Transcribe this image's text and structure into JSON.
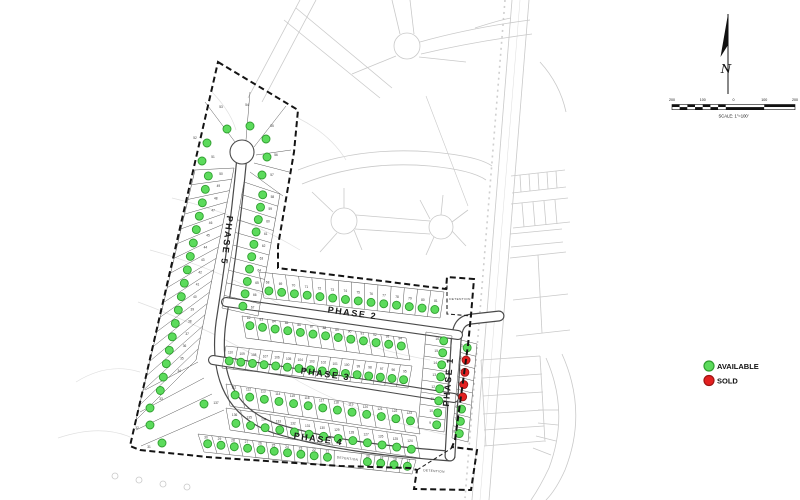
{
  "legend": {
    "available_label": "AVAILABLE",
    "sold_label": "SOLD",
    "available_color": "#5cdb5c",
    "available_stroke": "#2f9e2f",
    "sold_color": "#e32020",
    "sold_stroke": "#9e1414"
  },
  "compass": {
    "label": "N"
  },
  "scalebar": {
    "labels": [
      "200",
      "100",
      "0",
      "100",
      "200"
    ],
    "caption": "SCALE: 1\"=100'"
  },
  "map": {
    "det_label": "DETENTION",
    "sold_lots": [
      "2",
      "3",
      "4",
      "5"
    ],
    "colors": {
      "bg_line": "#c9c9c9",
      "contour": "#e0e0e0",
      "lot_line": "#5a5a5a",
      "road_casing": "#4a4a4a",
      "boundary": "#141414",
      "label": "#3a3a3a",
      "phase": "#1a1a1a"
    },
    "boundary": "M218,62 L298,110 L294,152 L278,246 L278,268 L446,289 L447,277 L474,279 L471,315 L468,345 L455,440 L452,447 L477,450 L471,490 L414,489 L417,470 L410,468 L340,466 L207,457 L140,450 L130,446 Z",
    "roads": [
      {
        "d": "M242,156 C236,220 229,272 221,322 C214,376 230,412 274,428 C332,446 398,452 450,456",
        "cw": 11,
        "iw": 8.6
      },
      {
        "d": "M450,456 C452,420 454,382 456,342 C457,326 461,320 472,319 L499,316",
        "cw": 11,
        "iw": 8.6
      },
      {
        "d": "M226,302 L458,335",
        "cw": 10,
        "iw": 7.8
      },
      {
        "d": "M213,360 L454,398",
        "cw": 10,
        "iw": 7.8
      }
    ],
    "culdesac": {
      "cx": 242,
      "cy": 152,
      "r": 12
    },
    "background": [
      {
        "d": "M512,0 L472,500"
      },
      {
        "d": "M529,0 L489,500"
      },
      {
        "d": "M520,0 L480,500",
        "c": "#dcdcdc",
        "w": 0.5
      },
      {
        "d": "M505,0 L465,498",
        "c": "#cfcfcf",
        "w": 1.6,
        "dash": "2,4"
      },
      {
        "d": "M300,0 L248,98"
      },
      {
        "d": "M316,0 L262,102"
      },
      {
        "d": "M284,20 L380,98"
      },
      {
        "d": "M296,8 L392,88"
      },
      {
        "d": "M420,42 Q470,28 530,20"
      },
      {
        "d": "M421,54 Q472,42 532,34"
      },
      {
        "d": "M400,34 L392,0"
      },
      {
        "d": "M414,34 L410,0"
      },
      {
        "d": "M396,56 L352,74"
      },
      {
        "d": "M419,57 L466,62"
      },
      {
        "d": "M298,170 Q360,146 432,152 Q478,156 492,166"
      },
      {
        "d": "M302,184 Q362,160 430,166 Q472,170 486,180"
      },
      {
        "d": "M356,215 L430,221"
      },
      {
        "d": "M355,229 L430,234"
      },
      {
        "d": "M333,212 L312,192"
      },
      {
        "d": "M337,233 L320,252"
      },
      {
        "d": "M344,208 L344,188"
      },
      {
        "d": "M354,230 L362,250"
      },
      {
        "d": "M430,219 L420,200"
      },
      {
        "d": "M434,237 L426,255"
      },
      {
        "d": "M441,215 L443,195"
      },
      {
        "d": "M452,231 L466,246"
      },
      {
        "d": "M452,222 L468,210"
      },
      {
        "d": "M426,96 L468,206",
        "w": 0.6
      },
      {
        "d": "M511,176 L565,170"
      },
      {
        "d": "M512,193 L566,187"
      },
      {
        "d": "M520,175 L521,192"
      },
      {
        "d": "M529,174 L530,191"
      },
      {
        "d": "M538,173 L539,190"
      },
      {
        "d": "M547,172 L548,189"
      },
      {
        "d": "M556,171 L557,188"
      },
      {
        "d": "M511,204 L568,198"
      },
      {
        "d": "M513,228 L570,222"
      },
      {
        "d": "M522,203 L524,227"
      },
      {
        "d": "M533,202 L535,226"
      },
      {
        "d": "M544,201 L546,225"
      },
      {
        "d": "M555,200 L557,224"
      },
      {
        "d": "M510,234 L562,229"
      },
      {
        "d": "M511,247 L563,242"
      },
      {
        "d": "M510,258 L566,252"
      },
      {
        "d": "M513,300 L568,294"
      },
      {
        "d": "M516,336 L570,330"
      },
      {
        "d": "M538,255 L542,333"
      },
      {
        "d": "M481,360 L540,356"
      },
      {
        "d": "M484,446 L544,441"
      },
      {
        "d": "M481,360 L486,446"
      },
      {
        "d": "M540,356 L545,442"
      },
      {
        "d": "M482,378 L542,374"
      },
      {
        "d": "M483,396 L543,392"
      },
      {
        "d": "M483,414 L543,410"
      },
      {
        "d": "M484,430 L544,426"
      },
      {
        "d": "M546,358 Q570,412 549,468 Q540,487 531,500"
      },
      {
        "d": "M562,354 Q588,412 565,470 Q556,490 546,500"
      },
      {
        "d": "M533,448 L551,455"
      },
      {
        "d": "M536,436 L556,441"
      },
      {
        "d": "M538,423 L558,425"
      },
      {
        "d": "M538,410 L559,410"
      },
      {
        "d": "M540,62 Q560,84 566,112"
      },
      {
        "d": "M475,28 Q500,20 511,18"
      }
    ],
    "bg_circles": [
      {
        "cx": 407,
        "cy": 46,
        "r": 13
      },
      {
        "cx": 344,
        "cy": 221,
        "r": 13
      },
      {
        "cx": 441,
        "cy": 227,
        "r": 12
      },
      {
        "cx": 115,
        "cy": 476,
        "r": 3
      },
      {
        "cx": 139,
        "cy": 480,
        "r": 3
      },
      {
        "cx": 163,
        "cy": 484,
        "r": 3
      },
      {
        "cx": 187,
        "cy": 487,
        "r": 3
      }
    ],
    "contours": [
      {
        "d": "M150,250 Q230,272 292,312 Q350,346 430,360"
      },
      {
        "d": "M138,302 Q220,332 300,382 Q370,420 452,436"
      },
      {
        "d": "M172,198 Q240,214 300,250"
      },
      {
        "d": "M76,382 Q108,362 140,372"
      },
      {
        "d": "M58,438 Q100,424 130,437"
      },
      {
        "d": "M298,118 Q330,134 346,160"
      },
      {
        "d": "M210,90 Q230,110 236,130"
      }
    ],
    "extra_lines": [
      {
        "d": "M235,142 L205,102"
      },
      {
        "d": "M246,140 L250,92"
      },
      {
        "d": "M254,147 L286,106"
      },
      {
        "d": "M256,155 L291,150"
      },
      {
        "d": "M254,163 L289,172"
      },
      {
        "d": "M250,172 L283,196"
      },
      {
        "d": "M198,362 L145,390"
      },
      {
        "d": "M204,378 L140,412"
      },
      {
        "d": "M212,394 L136,430"
      },
      {
        "d": "M224,410 L141,446"
      },
      {
        "d": "M447,279 L447,314 L472,316",
        "dash": "4,2.5",
        "w": 1.1,
        "c": "#222222"
      },
      {
        "d": "M417,470 L452,448",
        "dash": "4,2.5",
        "w": 1.1,
        "c": "#222222"
      }
    ],
    "rows": [
      {
        "name": "phase5-west-column",
        "front": [
          234,
          168,
          196,
          360
        ],
        "back": [
          195,
          170,
          136,
          420
        ],
        "dot_t": 0.62,
        "label_t": 0.3,
        "lots": [
          "50",
          "49",
          "48",
          "47",
          "46",
          "45",
          "44",
          "43",
          "42",
          "41",
          "40",
          "39",
          "38",
          "37",
          "36",
          "35",
          "34"
        ]
      },
      {
        "name": "phase5-east-column",
        "front": [
          244,
          182,
          222,
          308
        ],
        "back": [
          280,
          194,
          258,
          316
        ],
        "dot_t": 0.55,
        "label_t": 0.82,
        "lots": [
          "58",
          "59",
          "60",
          "61",
          "62",
          "63",
          "64",
          "65",
          "66",
          "67"
        ]
      },
      {
        "name": "phase2-north-row",
        "front": [
          264,
          298,
          440,
          318
        ],
        "back": [
          259,
          272,
          444,
          292
        ],
        "dot_t": 0.3,
        "label_t": 0.58,
        "lots": [
          "68",
          "69",
          "70",
          "71",
          "72",
          "73",
          "74",
          "75",
          "76",
          "77",
          "78",
          "79",
          "80",
          "81"
        ]
      },
      {
        "name": "phase2-south-row",
        "front": [
          242,
          316,
          406,
          338
        ],
        "back": [
          246,
          338,
          410,
          360
        ],
        "dot_t": 0.4,
        "label_t": 0.1,
        "lots": [
          "82",
          "83",
          "84",
          "85",
          "86",
          "87",
          "88",
          "89",
          "90",
          "91",
          "92",
          "93",
          "94"
        ]
      },
      {
        "name": "phase3-north-row",
        "front": [
          222,
          368,
          408,
          388
        ],
        "back": [
          226,
          346,
          412,
          366
        ],
        "dot_t": 0.35,
        "label_t": 0.68,
        "lots": [
          "110",
          "109",
          "108",
          "107",
          "106",
          "105",
          "104",
          "103",
          "102",
          "101",
          "100",
          "99",
          "98",
          "97",
          "96",
          "95"
        ]
      },
      {
        "name": "phase3-south-row",
        "front": [
          226,
          384,
          416,
          412
        ],
        "back": [
          230,
          406,
          420,
          434
        ],
        "dot_t": 0.45,
        "label_t": 0.15,
        "lots": [
          "111",
          "112",
          "113",
          "114",
          "115",
          "116",
          "117",
          "118",
          "119",
          "120",
          "121",
          "122",
          "123"
        ]
      },
      {
        "name": "phase4-north-row",
        "front": [
          230,
          430,
          420,
          458
        ],
        "back": [
          226,
          408,
          416,
          436
        ],
        "dot_t": 0.35,
        "label_t": 0.68,
        "lots": [
          "136",
          "135",
          "134",
          "133",
          "132",
          "131",
          "130",
          "129",
          "128",
          "127",
          "126",
          "125",
          "124"
        ]
      },
      {
        "name": "phase4-south-row",
        "front": [
          198,
          434,
          416,
          460
        ],
        "back": [
          204,
          452,
          412,
          474
        ],
        "dot_t": 0.5,
        "label_t": 0.2,
        "lots": [
          "30",
          "29",
          "28",
          "27",
          "26",
          "25",
          "24",
          "23",
          "22",
          "21",
          {
            "det": true,
            "w": 2
          },
          "20",
          "19",
          "18",
          "17"
        ]
      },
      {
        "name": "phase1-west-column",
        "front": [
          452,
          336,
          444,
          432
        ],
        "back": [
          426,
          332,
          418,
          428
        ],
        "dot_t": 0.3,
        "label_t": 0.55,
        "lots": [
          "16",
          "15",
          "14",
          "13",
          "12",
          "11",
          "10",
          "9"
        ]
      },
      {
        "name": "phase1-east-column",
        "front": [
          461,
          340,
          452,
          438
        ],
        "back": [
          477,
          344,
          468,
          442
        ],
        "dot_t": 0.42,
        "label_t": 0.1,
        "lots": [
          "1",
          "2",
          "3",
          "4",
          "5",
          "6",
          "7",
          "8"
        ]
      }
    ],
    "singles": [
      {
        "n": "54",
        "x": 250,
        "y": 126,
        "lx": 247,
        "ly": 106
      },
      {
        "n": "53",
        "x": 227,
        "y": 129,
        "lx": 221,
        "ly": 108
      },
      {
        "n": "52",
        "x": 207,
        "y": 143,
        "lx": 195,
        "ly": 139
      },
      {
        "n": "51",
        "x": 202,
        "y": 161,
        "lx": 213,
        "ly": 158
      },
      {
        "n": "55",
        "x": 266,
        "y": 139,
        "lx": 272,
        "ly": 127
      },
      {
        "n": "56",
        "x": 267,
        "y": 157,
        "lx": 276,
        "ly": 156
      },
      {
        "n": "57",
        "x": 262,
        "y": 175,
        "lx": 272,
        "ly": 176
      },
      {
        "n": "33",
        "x": 150,
        "y": 408,
        "lx": 161,
        "ly": 400
      },
      {
        "n": "32",
        "x": 150,
        "y": 425,
        "lx": 137,
        "ly": 429
      },
      {
        "n": "31",
        "x": 162,
        "y": 443,
        "lx": 149,
        "ly": 448
      },
      {
        "n": "137",
        "x": 204,
        "y": 404,
        "lx": 216,
        "ly": 404
      }
    ],
    "phase_labels": [
      {
        "t": "PHASE 5",
        "x": 224,
        "y": 240,
        "r": 97
      },
      {
        "t": "PHASE 2",
        "x": 352,
        "y": 316,
        "r": 8
      },
      {
        "t": "PHASE 3",
        "x": 325,
        "y": 377,
        "r": 8
      },
      {
        "t": "PHASE 4",
        "x": 318,
        "y": 442,
        "r": 8
      },
      {
        "t": "PHASE 1",
        "x": 451,
        "y": 382,
        "r": -85
      }
    ],
    "detention_labels": [
      {
        "t": "DETENTION",
        "x": 460,
        "y": 300,
        "r": 0
      },
      {
        "t": "DETENTION",
        "x": 434,
        "y": 472,
        "r": 4
      }
    ]
  }
}
